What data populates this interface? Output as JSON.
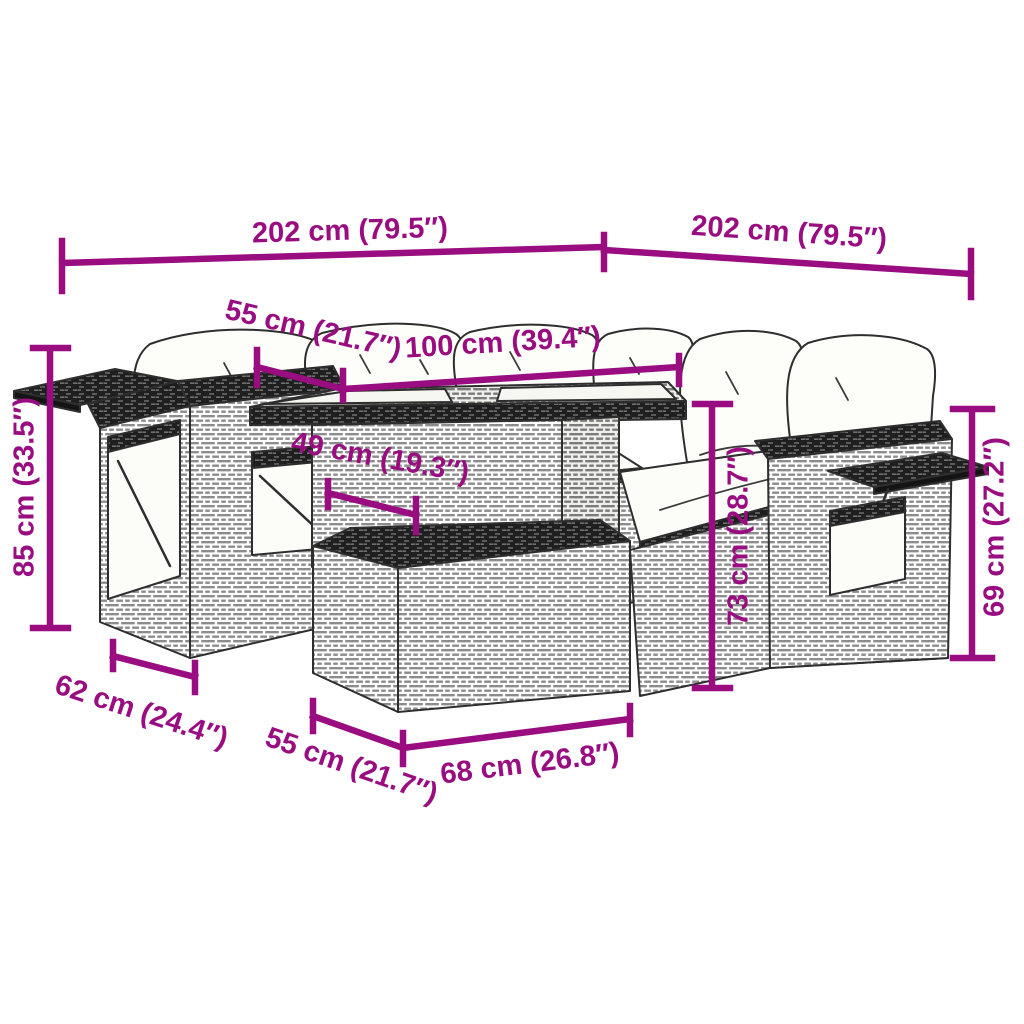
{
  "diagram": {
    "subject": "garden-lounge-set-with-table-and-ottoman",
    "accent_color": "#990D81",
    "line_color": "#2e2e2e",
    "background_color": "#ffffff",
    "dimensions": [
      {
        "id": "overall-width-left",
        "label": "202 cm (79.5″)"
      },
      {
        "id": "overall-width-right",
        "label": "202 cm (79.5″)"
      },
      {
        "id": "sofa-section-depth",
        "label": "55 cm (21.7″)"
      },
      {
        "id": "table-width",
        "label": "100 cm (39.4″)"
      },
      {
        "id": "table-depth",
        "label": "49 cm (19.3″)"
      },
      {
        "id": "overall-height",
        "label": "85 cm (33.5″)"
      },
      {
        "id": "armrest-module-depth",
        "label": "62 cm (24.4″)"
      },
      {
        "id": "ottoman-depth",
        "label": "55 cm (21.7″)"
      },
      {
        "id": "ottoman-width",
        "label": "68 cm (26.8″)"
      },
      {
        "id": "table-height",
        "label": "73 cm (28.7″)"
      },
      {
        "id": "backrest-height",
        "label": "69 cm (27.2″)"
      }
    ]
  }
}
